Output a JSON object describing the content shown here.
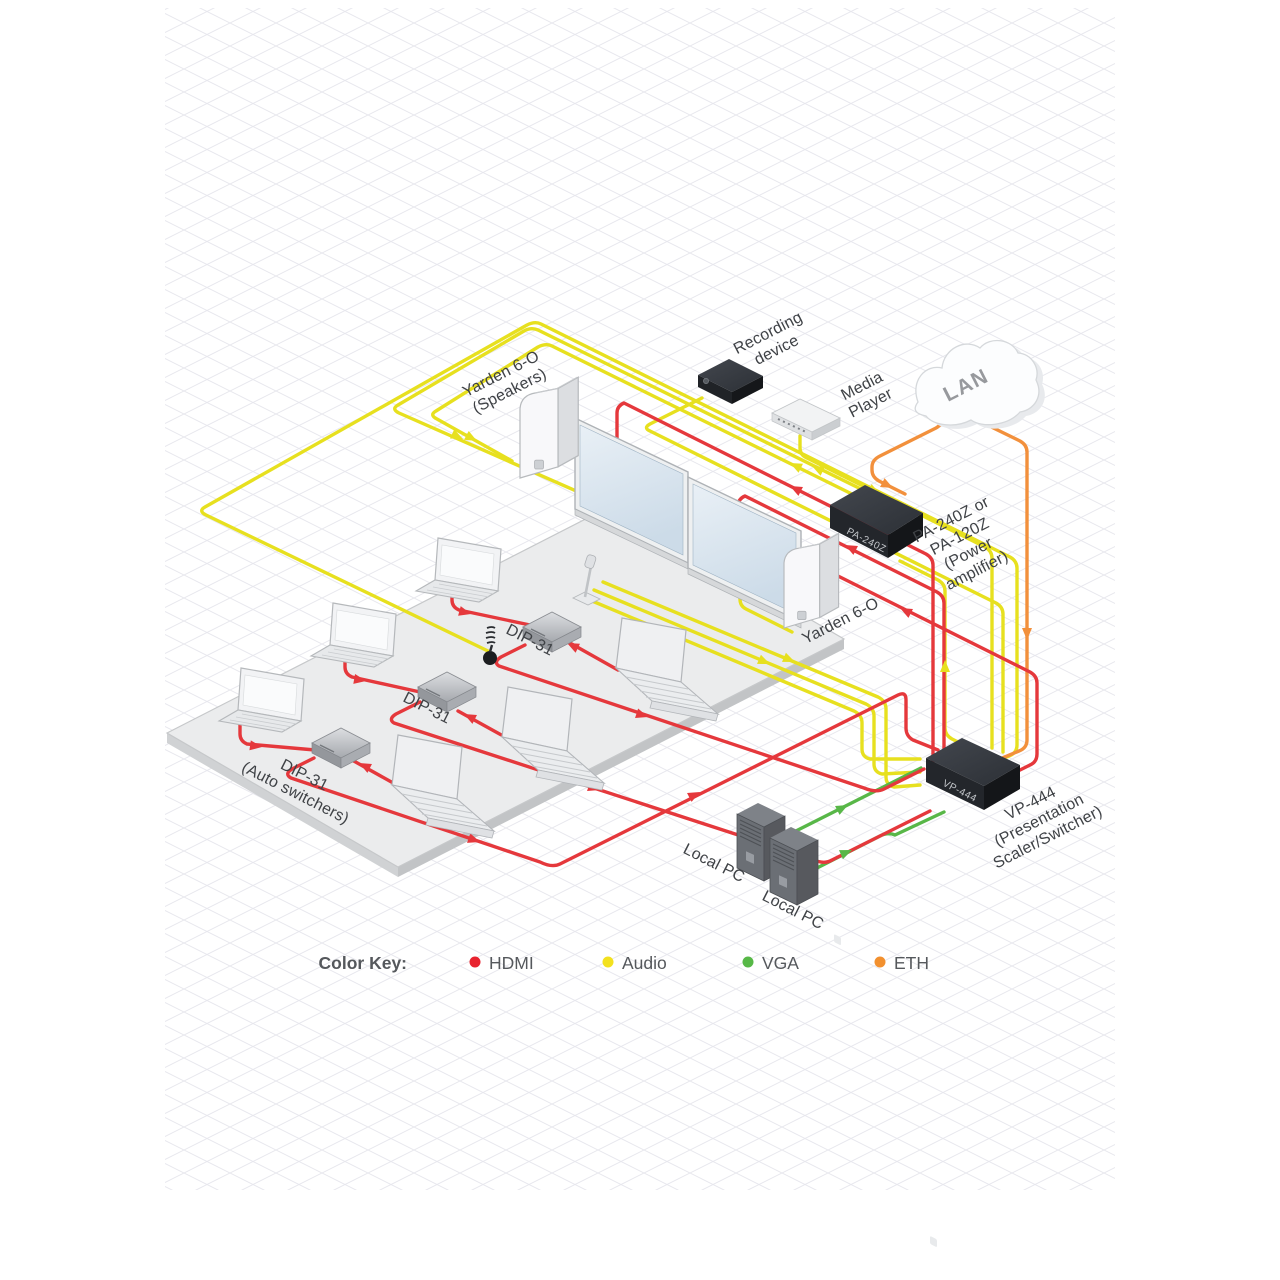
{
  "title": "AV presentation system wiring diagram",
  "colors": {
    "hdmi": "#e5383c",
    "audio": "#e7e01f",
    "vga": "#58b748",
    "eth": "#f2903c",
    "label": "#3f4246",
    "grid": "#e7e7ed"
  },
  "nodes": {
    "speakers_left": {
      "line1": "Yarden 6-O",
      "line2": "(Speakers)"
    },
    "recording": {
      "line1": "Recording",
      "line2": "device"
    },
    "media_player": {
      "line1": "Media",
      "line2": "Player"
    },
    "lan": {
      "label": "LAN"
    },
    "pa": {
      "line1": "PA-240Z or",
      "line2": "PA-120Z",
      "line3": "(Power",
      "line4": "amplifier)",
      "front_label": "PA-240Z"
    },
    "dip1": {
      "label": "DIP-31"
    },
    "dip2": {
      "label": "DIP-31"
    },
    "dip3": {
      "line1": "DIP-31",
      "line2": "(Auto switchers)"
    },
    "yarden_right": {
      "label": "Yarden 6-O"
    },
    "vp": {
      "line1": "VP-444",
      "line2": "(Presentation",
      "line3": "Scaler/Switcher)",
      "front_label": "VP-444"
    },
    "local_pc1": {
      "label": "Local PC"
    },
    "local_pc2": {
      "label": "Local PC"
    }
  },
  "legend": {
    "title": "Color Key:",
    "items": [
      {
        "label": "HDMI",
        "color": "#e8232f"
      },
      {
        "label": "Audio",
        "color": "#f3e11e"
      },
      {
        "label": "VGA",
        "color": "#57b847"
      },
      {
        "label": "ETH",
        "color": "#f2902e"
      }
    ]
  }
}
